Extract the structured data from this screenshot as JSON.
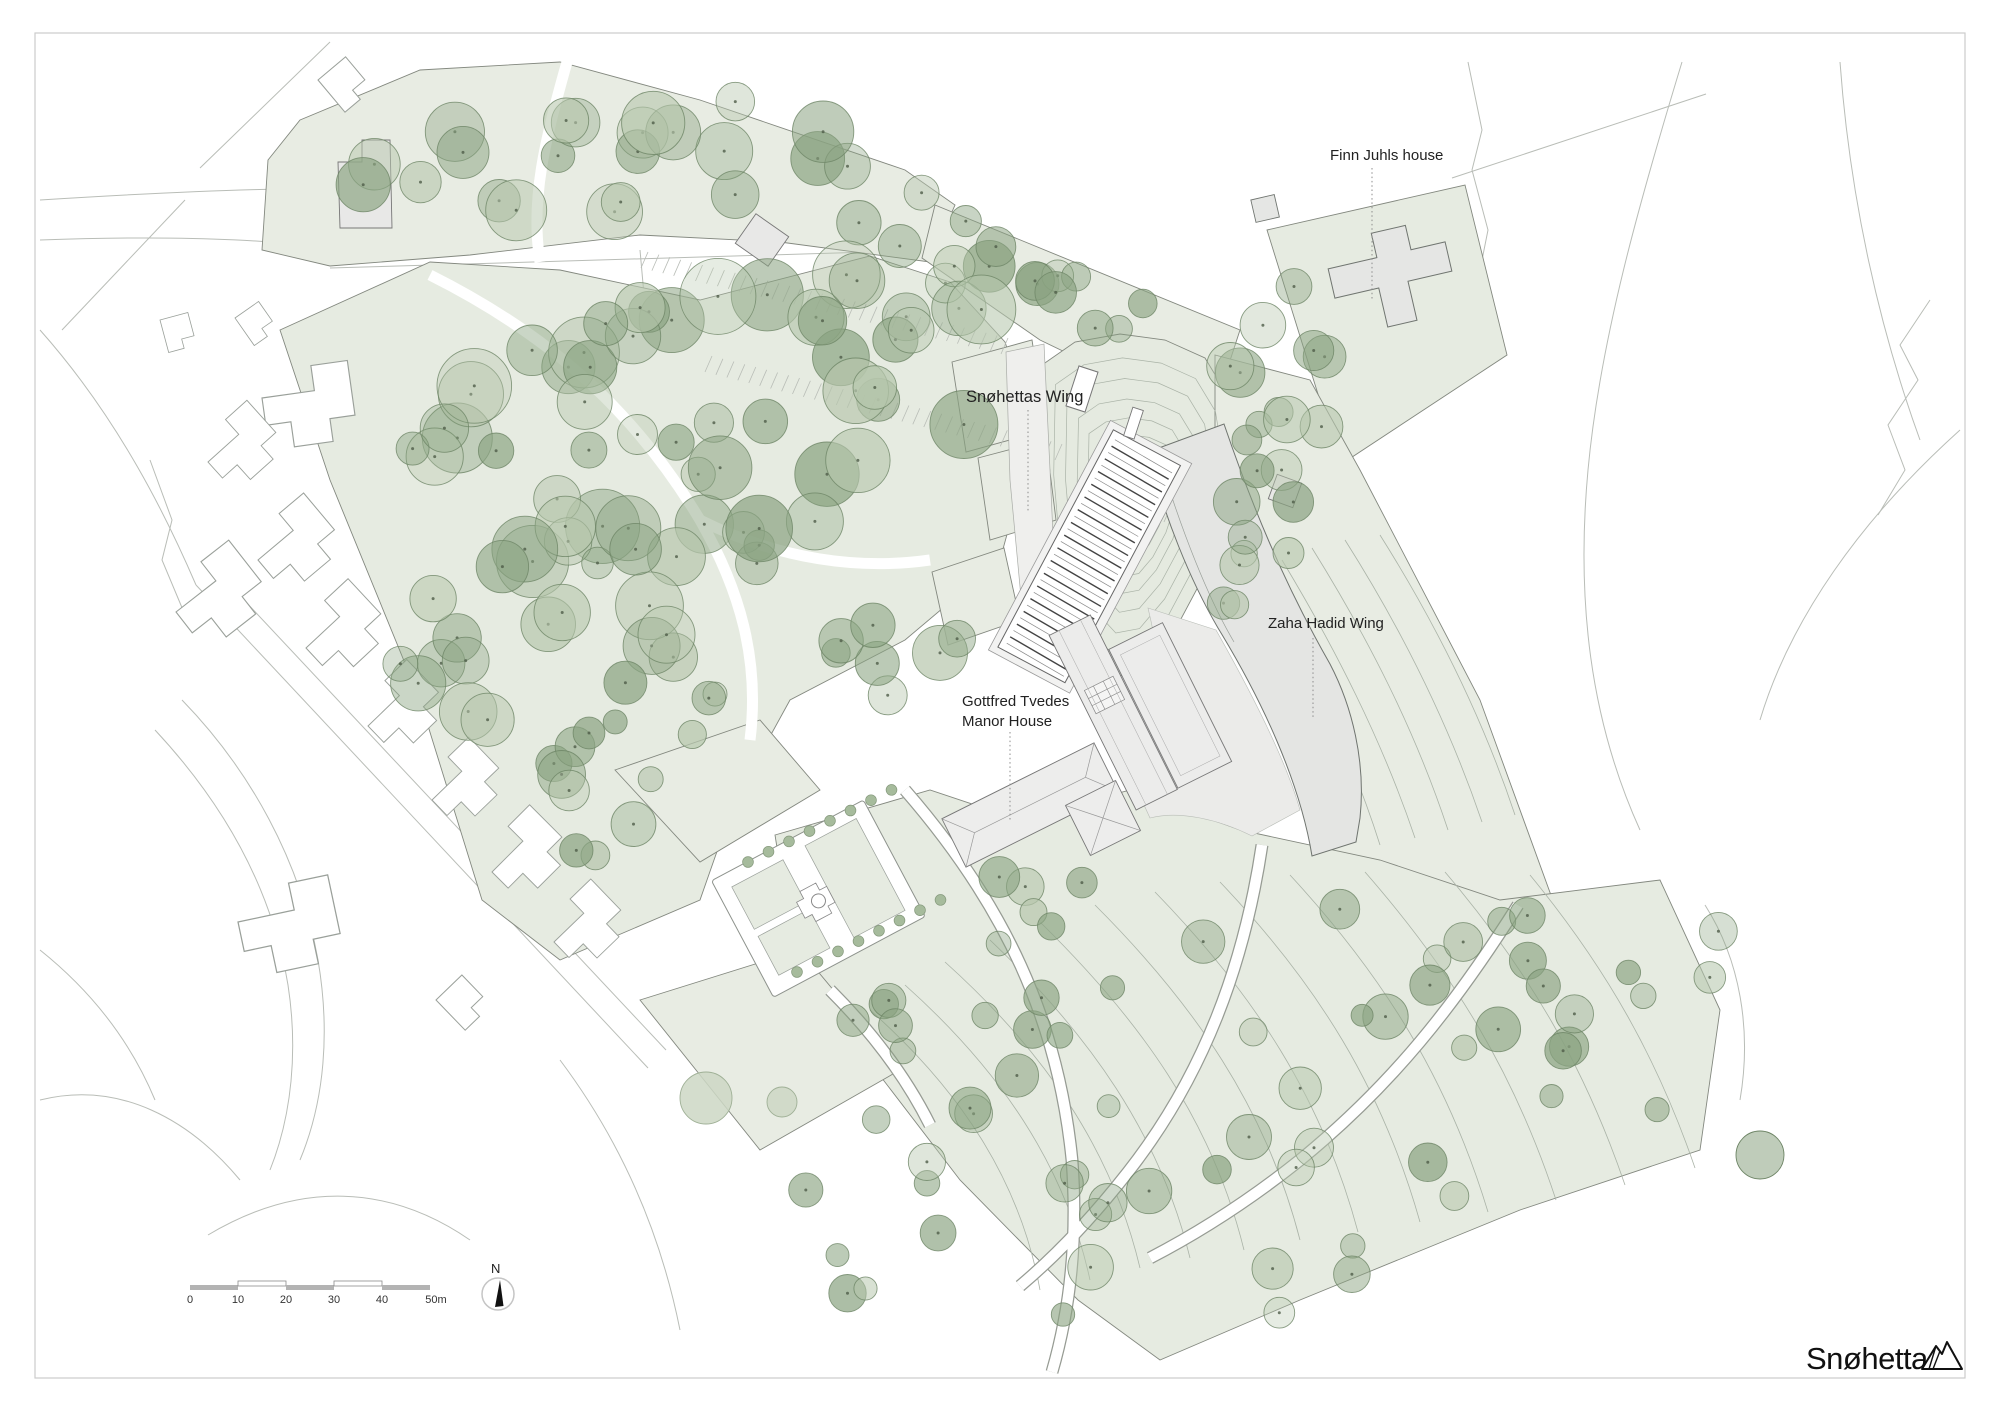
{
  "labels": {
    "finn_juhl_house": "Finn Juhls house",
    "snohetta_wing": "Snøhettas Wing",
    "zaha_hadid_wing": "Zaha Hadid Wing",
    "manor_house_line1": "Gottfred Tvedes",
    "manor_house_line2": "Manor House"
  },
  "scale_bar": {
    "ticks": [
      "0",
      "10",
      "20",
      "30",
      "40",
      "50m"
    ]
  },
  "north_arrow": {
    "label": "N"
  },
  "logo": {
    "wordmark": "Snøhetta"
  },
  "colors": {
    "site_green": "#e8ece3",
    "site_green_dark": "#e2e8df",
    "tree_green": "#8aa381",
    "tree_green_light": "#b6c6ac",
    "tree_outline": "#6d8465",
    "building_gray": "#e7e8e6",
    "line_gray": "#b9bdb7",
    "contour_gray": "#aab3a7",
    "ink": "#1a1a1a"
  }
}
